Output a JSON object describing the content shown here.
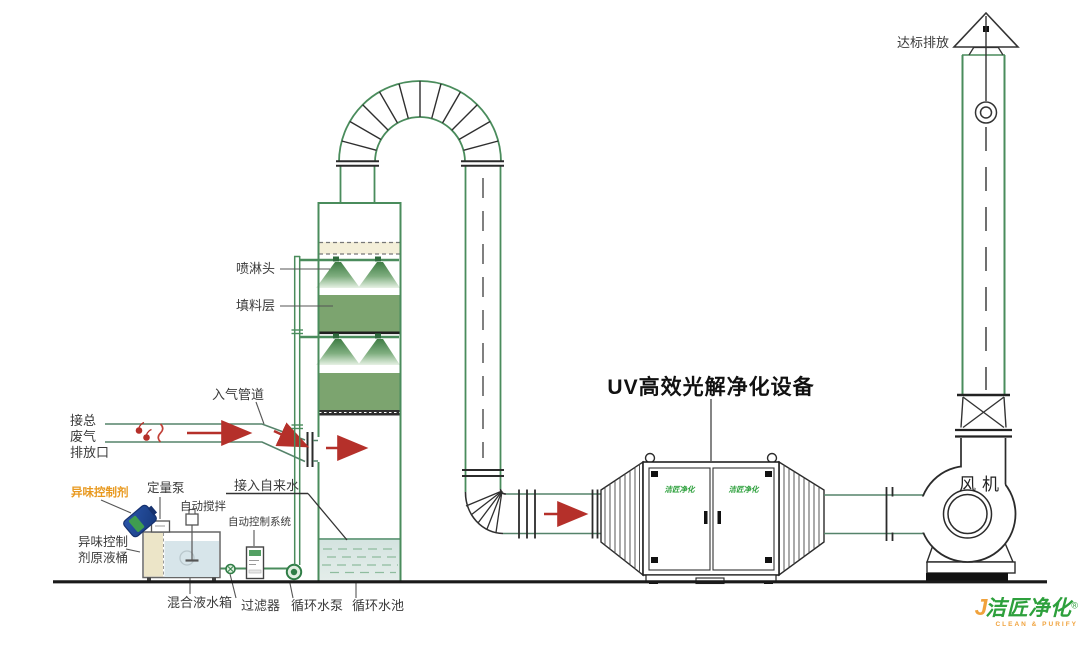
{
  "labels": {
    "emission": "达标排放",
    "spray_head": "喷淋头",
    "packing_layer": "填料层",
    "inlet_duct": "入气管道",
    "waste_inlet_line1": "接总",
    "waste_inlet_line2": "废气",
    "waste_inlet_line3": "排放口",
    "odor_agent": "异味控制剂",
    "metering_pump": "定量泵",
    "auto_mixer": "自动搅拌",
    "auto_control_system": "自动控制系统",
    "agent_tank_line1": "异味控制",
    "agent_tank_line2": "剂原液桶",
    "tap_water": "接入自来水",
    "mixing_tank": "混合液水箱",
    "filter": "过滤器",
    "circulating_pump": "循环水泵",
    "circulating_pool": "循环水池",
    "uv_title": "UV高效光解净化设备",
    "fan": "风机"
  },
  "logo": {
    "initial": "J",
    "name": "洁匠净化",
    "registered": "®",
    "subtitle": "CLEAN & PURIFY",
    "door_label": "洁匠净化"
  },
  "colors": {
    "line_green": "#4a8c5c",
    "packing_green": "#7ca46f",
    "spray_green": "#3f7d45",
    "pool_water": "#dce8e4",
    "tank_water": "#d7e5ea",
    "demister_beige": "#f4efd9",
    "arrow_red": "#b5302a",
    "accent_orange": "#e8991f",
    "logo_green": "#2da03c",
    "logo_orange": "#f0a23c",
    "barrel_blue": "#1e4fa3"
  }
}
